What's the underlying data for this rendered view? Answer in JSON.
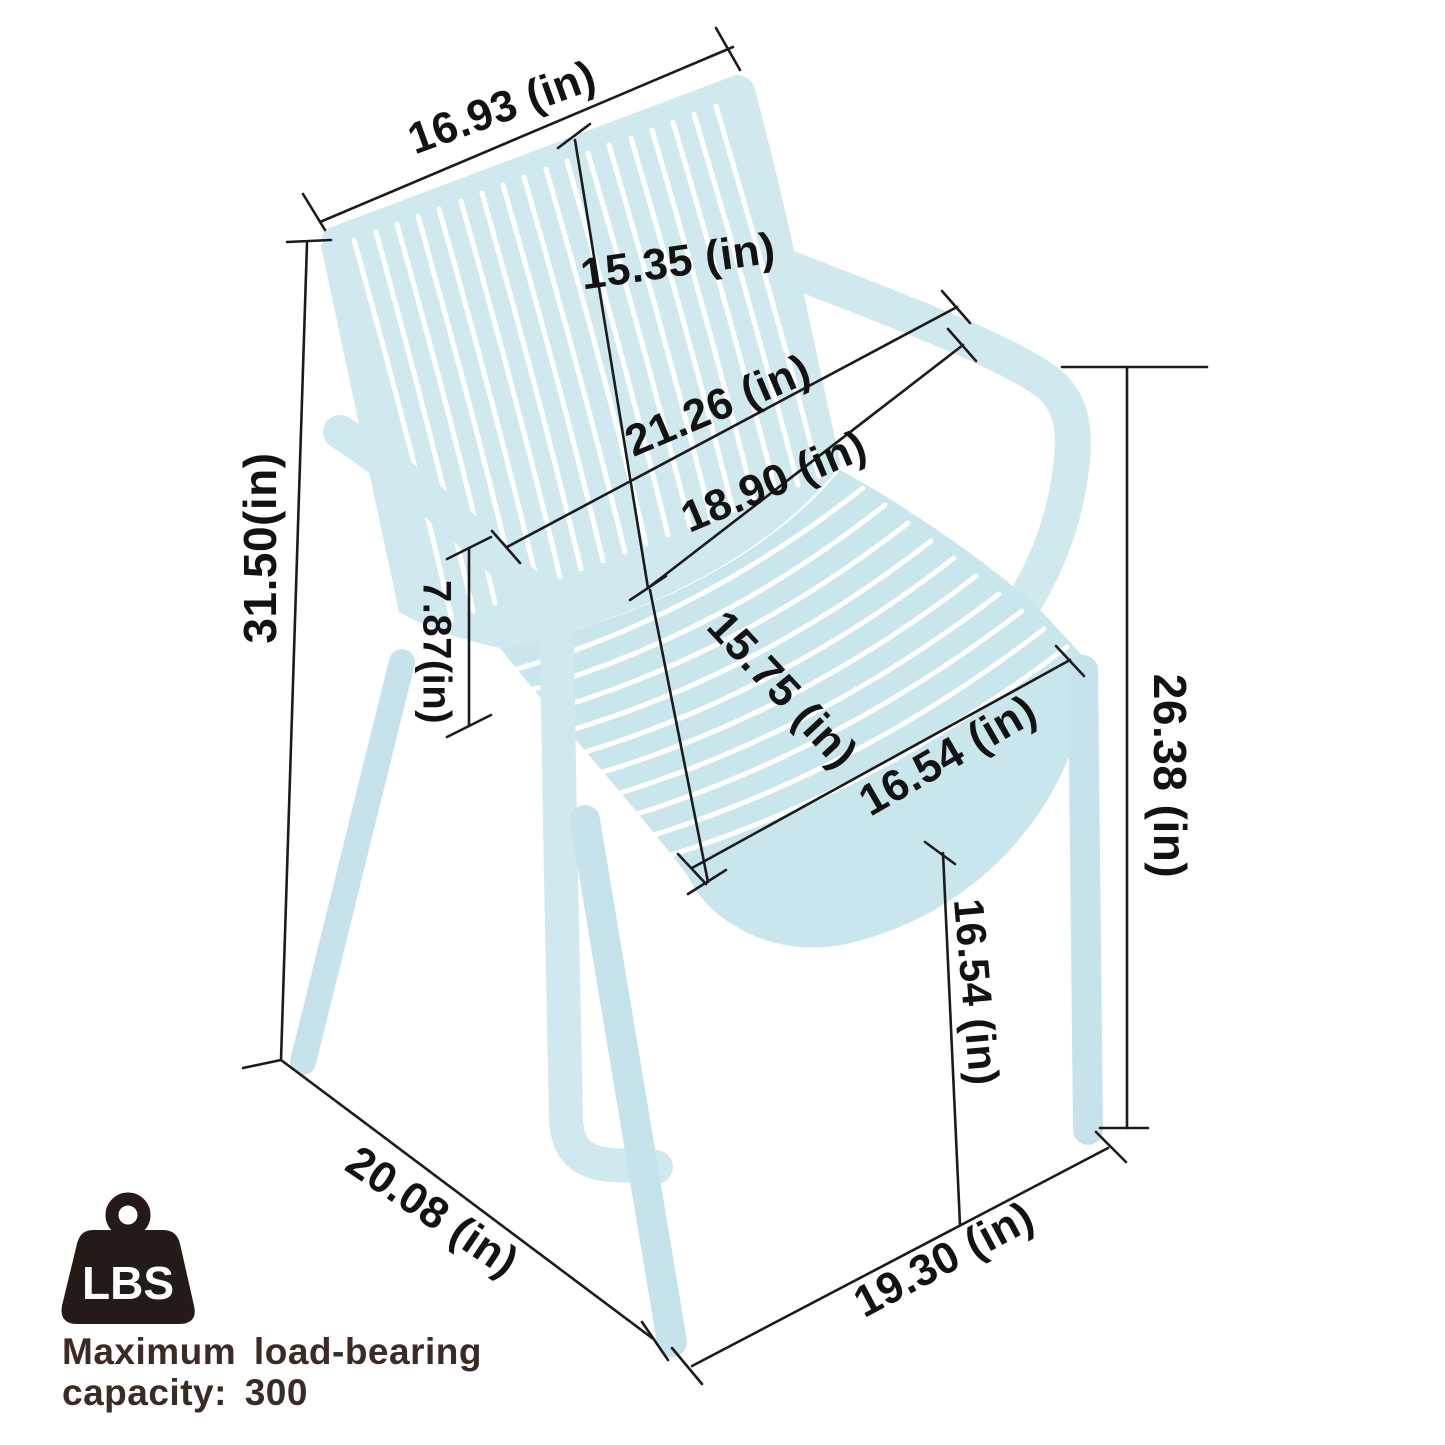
{
  "dimensions": {
    "backrest_top_width": "16.93 (in)",
    "backrest_height": "15.35 (in)",
    "overall_width_armrests": "21.26 (in)",
    "backrest_bottom_width": "18.90 (in)",
    "overall_height": "31.50(in)",
    "armrest_above_seat_height": "7.87(in)",
    "seat_depth": "15.75 (in)",
    "seat_width": "16.54 (in)",
    "seat_front_height": "16.54 (in)",
    "armrest_to_floor_height": "26.38 (in)",
    "base_depth": "20.08 (in)",
    "base_width": "19.30 (in)"
  },
  "load_badge": {
    "icon_label": "LBS",
    "caption_line1": "Maximum load-bearing",
    "caption_line2": "capacity: 300"
  },
  "colors": {
    "chair_body": "#cfe9ef",
    "chair_seat": "#c9e6ed",
    "dimension_line": "#1b1b1b",
    "badge_icon": "#241a17",
    "caption_text": "#3c2a24"
  }
}
